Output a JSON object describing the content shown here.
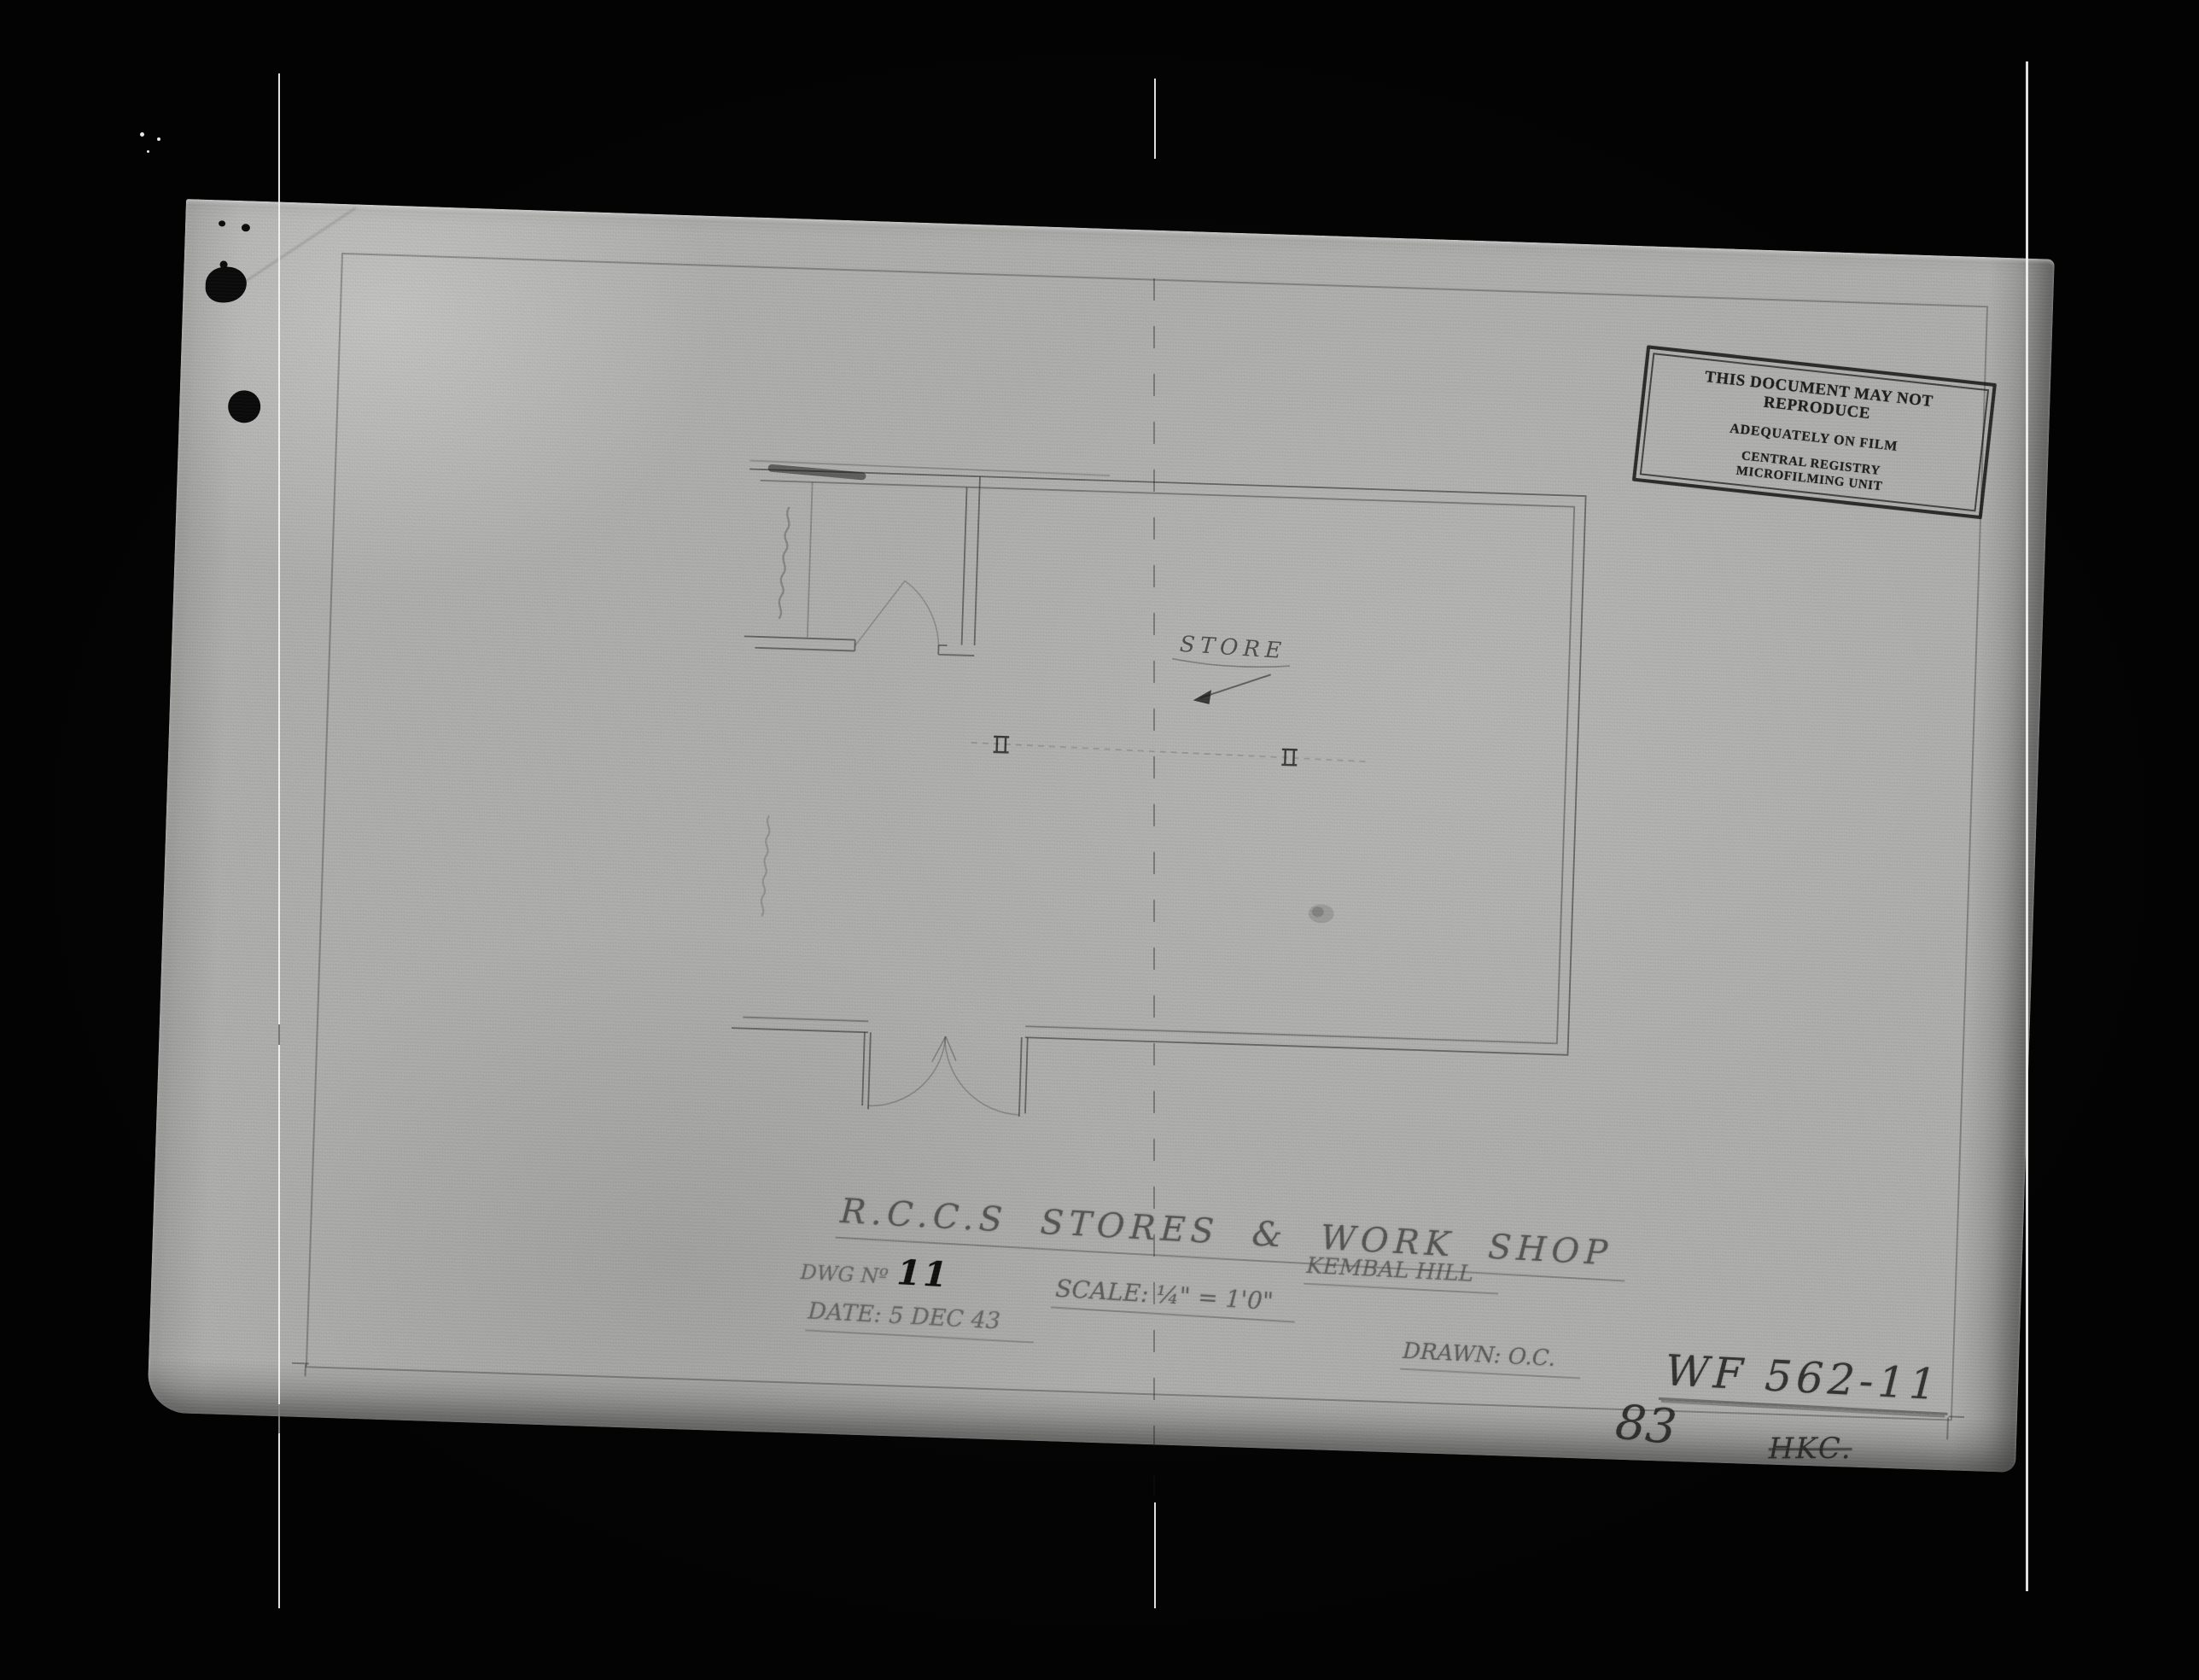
{
  "stamp": {
    "lines": [
      "THIS DOCUMENT MAY NOT REPRODUCE",
      "ADEQUATELY ON FILM",
      "CENTRAL REGISTRY",
      "MICROFILMING UNIT"
    ]
  },
  "plan": {
    "room_label": "STORE"
  },
  "title_block": {
    "title": "R.C.C.S  STORES & WORK SHOP",
    "dwg_no_label": "DWG Nº",
    "dwg_no": "11",
    "scale": "SCALE: ¼\" = 1'0\"",
    "date": "DATE: 5 DEC 43",
    "location": "KEMBAL HILL",
    "drawn": "DRAWN: O.C."
  },
  "annotations": {
    "file_number": "WF 562-11",
    "frame_number": "83",
    "initials": "HKC."
  },
  "colors": {
    "film_black": "#040404",
    "paper_gray": "#aeaeac",
    "pencil": "#2d2d2d",
    "stamp_ink": "#141414"
  }
}
